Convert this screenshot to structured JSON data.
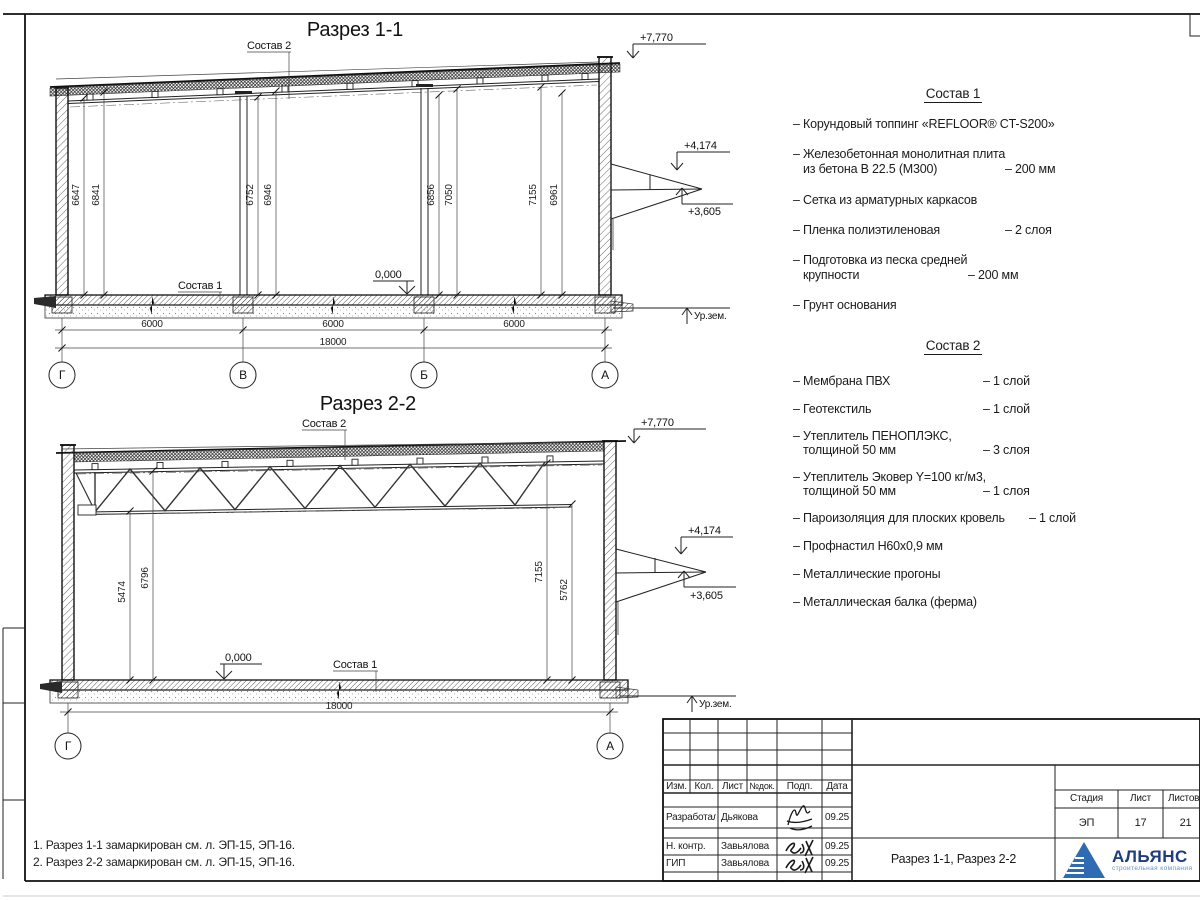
{
  "sections": {
    "s1": {
      "title": "Разрез 1-1",
      "axes": [
        "Г",
        "В",
        "Б",
        "А"
      ],
      "dims_h": [
        "6000",
        "6000",
        "6000",
        "18000"
      ],
      "dims_v": [
        "6647",
        "6841",
        "6752",
        "6946",
        "6856",
        "7050",
        "7155",
        "6961"
      ],
      "elev_top": "+7,770",
      "elev_canopy_top": "+4,174",
      "elev_canopy_bot": "+3,605",
      "elev_zero": "0,000",
      "ground": "Ур.зем.",
      "label_sostav1": "Состав 1",
      "label_sostav2": "Состав 2"
    },
    "s2": {
      "title": "Разрез 2-2",
      "axes": [
        "Г",
        "А"
      ],
      "dims_h": [
        "18000"
      ],
      "dims_v": [
        "5474",
        "6796",
        "7155",
        "5762"
      ],
      "elev_top": "+7,770",
      "elev_canopy_top": "+4,174",
      "elev_canopy_bot": "+3,605",
      "elev_zero": "0,000",
      "ground": "Ур.зем.",
      "label_sostav1": "Состав 1",
      "label_sostav2": "Состав 2"
    }
  },
  "sostav1": {
    "title": "Состав 1",
    "lines": [
      {
        "t": "– Корундовый топпинг «REFLOOR® CT-S200»",
        "v": ""
      },
      {
        "t": "– Железобетонная  монолитная плита",
        "v": ""
      },
      {
        "t": "из бетона В 22.5 (М300)",
        "v": "– 200 мм"
      },
      {
        "t": "– Сетка из арматурных каркасов",
        "v": ""
      },
      {
        "t": "– Пленка полиэтиленовая",
        "v": "– 2 слоя"
      },
      {
        "t": "– Подготовка из песка средней",
        "v": ""
      },
      {
        "t": "крупности",
        "v": "– 200 мм"
      },
      {
        "t": "– Грунт основания",
        "v": ""
      }
    ]
  },
  "sostav2": {
    "title": "Состав 2",
    "lines": [
      {
        "t": "– Мембрана ПВХ",
        "v": "– 1 слой"
      },
      {
        "t": "– Геотекстиль",
        "v": "– 1 слой"
      },
      {
        "t": "– Утеплитель ПЕНОПЛЭКС,",
        "v": ""
      },
      {
        "t": "толщиной 50 мм",
        "v": "– 3 слоя"
      },
      {
        "t": "– Утеплитель Эковер Y=100 кг/м3,",
        "v": ""
      },
      {
        "t": "толщиной 50 мм",
        "v": "– 1 слоя"
      },
      {
        "t": "– Пароизоляция для плоских кровель",
        "v": "– 1 слой"
      },
      {
        "t": "– Профнастил Н60х0,9 мм",
        "v": ""
      },
      {
        "t": "– Металлические прогоны",
        "v": ""
      },
      {
        "t": "– Металлическая балка (ферма)",
        "v": ""
      }
    ]
  },
  "notes": [
    "1. Разрез 1-1 замаркирован см. л. ЭП-15, ЭП-16.",
    "2. Разрез 2-2 замаркирован см. л. ЭП-15, ЭП-16."
  ],
  "titleblock": {
    "headers": [
      "Изм.",
      "Кол.",
      "Лист",
      "№док.",
      "Подп.",
      "Дата"
    ],
    "rows": [
      {
        "role": "Разработал",
        "name": "Дьякова",
        "date": "09.25"
      },
      {
        "role": "Н. контр.",
        "name": "Завьялова",
        "date": "09.25"
      },
      {
        "role": "ГИП",
        "name": "Завьялова",
        "date": "09.25"
      }
    ],
    "stage_label": "Стадия",
    "sheet_label": "Лист",
    "sheets_label": "Листов",
    "stage": "ЭП",
    "sheet_no": "17",
    "sheets_total": "21",
    "title": "Разрез 1-1, Разрез 2-2",
    "logo_name": "АЛЬЯНС",
    "logo_tagline": "строительная компания",
    "logo_color": "#2f6bb3",
    "logo_text_color": "#1e3d7b"
  }
}
